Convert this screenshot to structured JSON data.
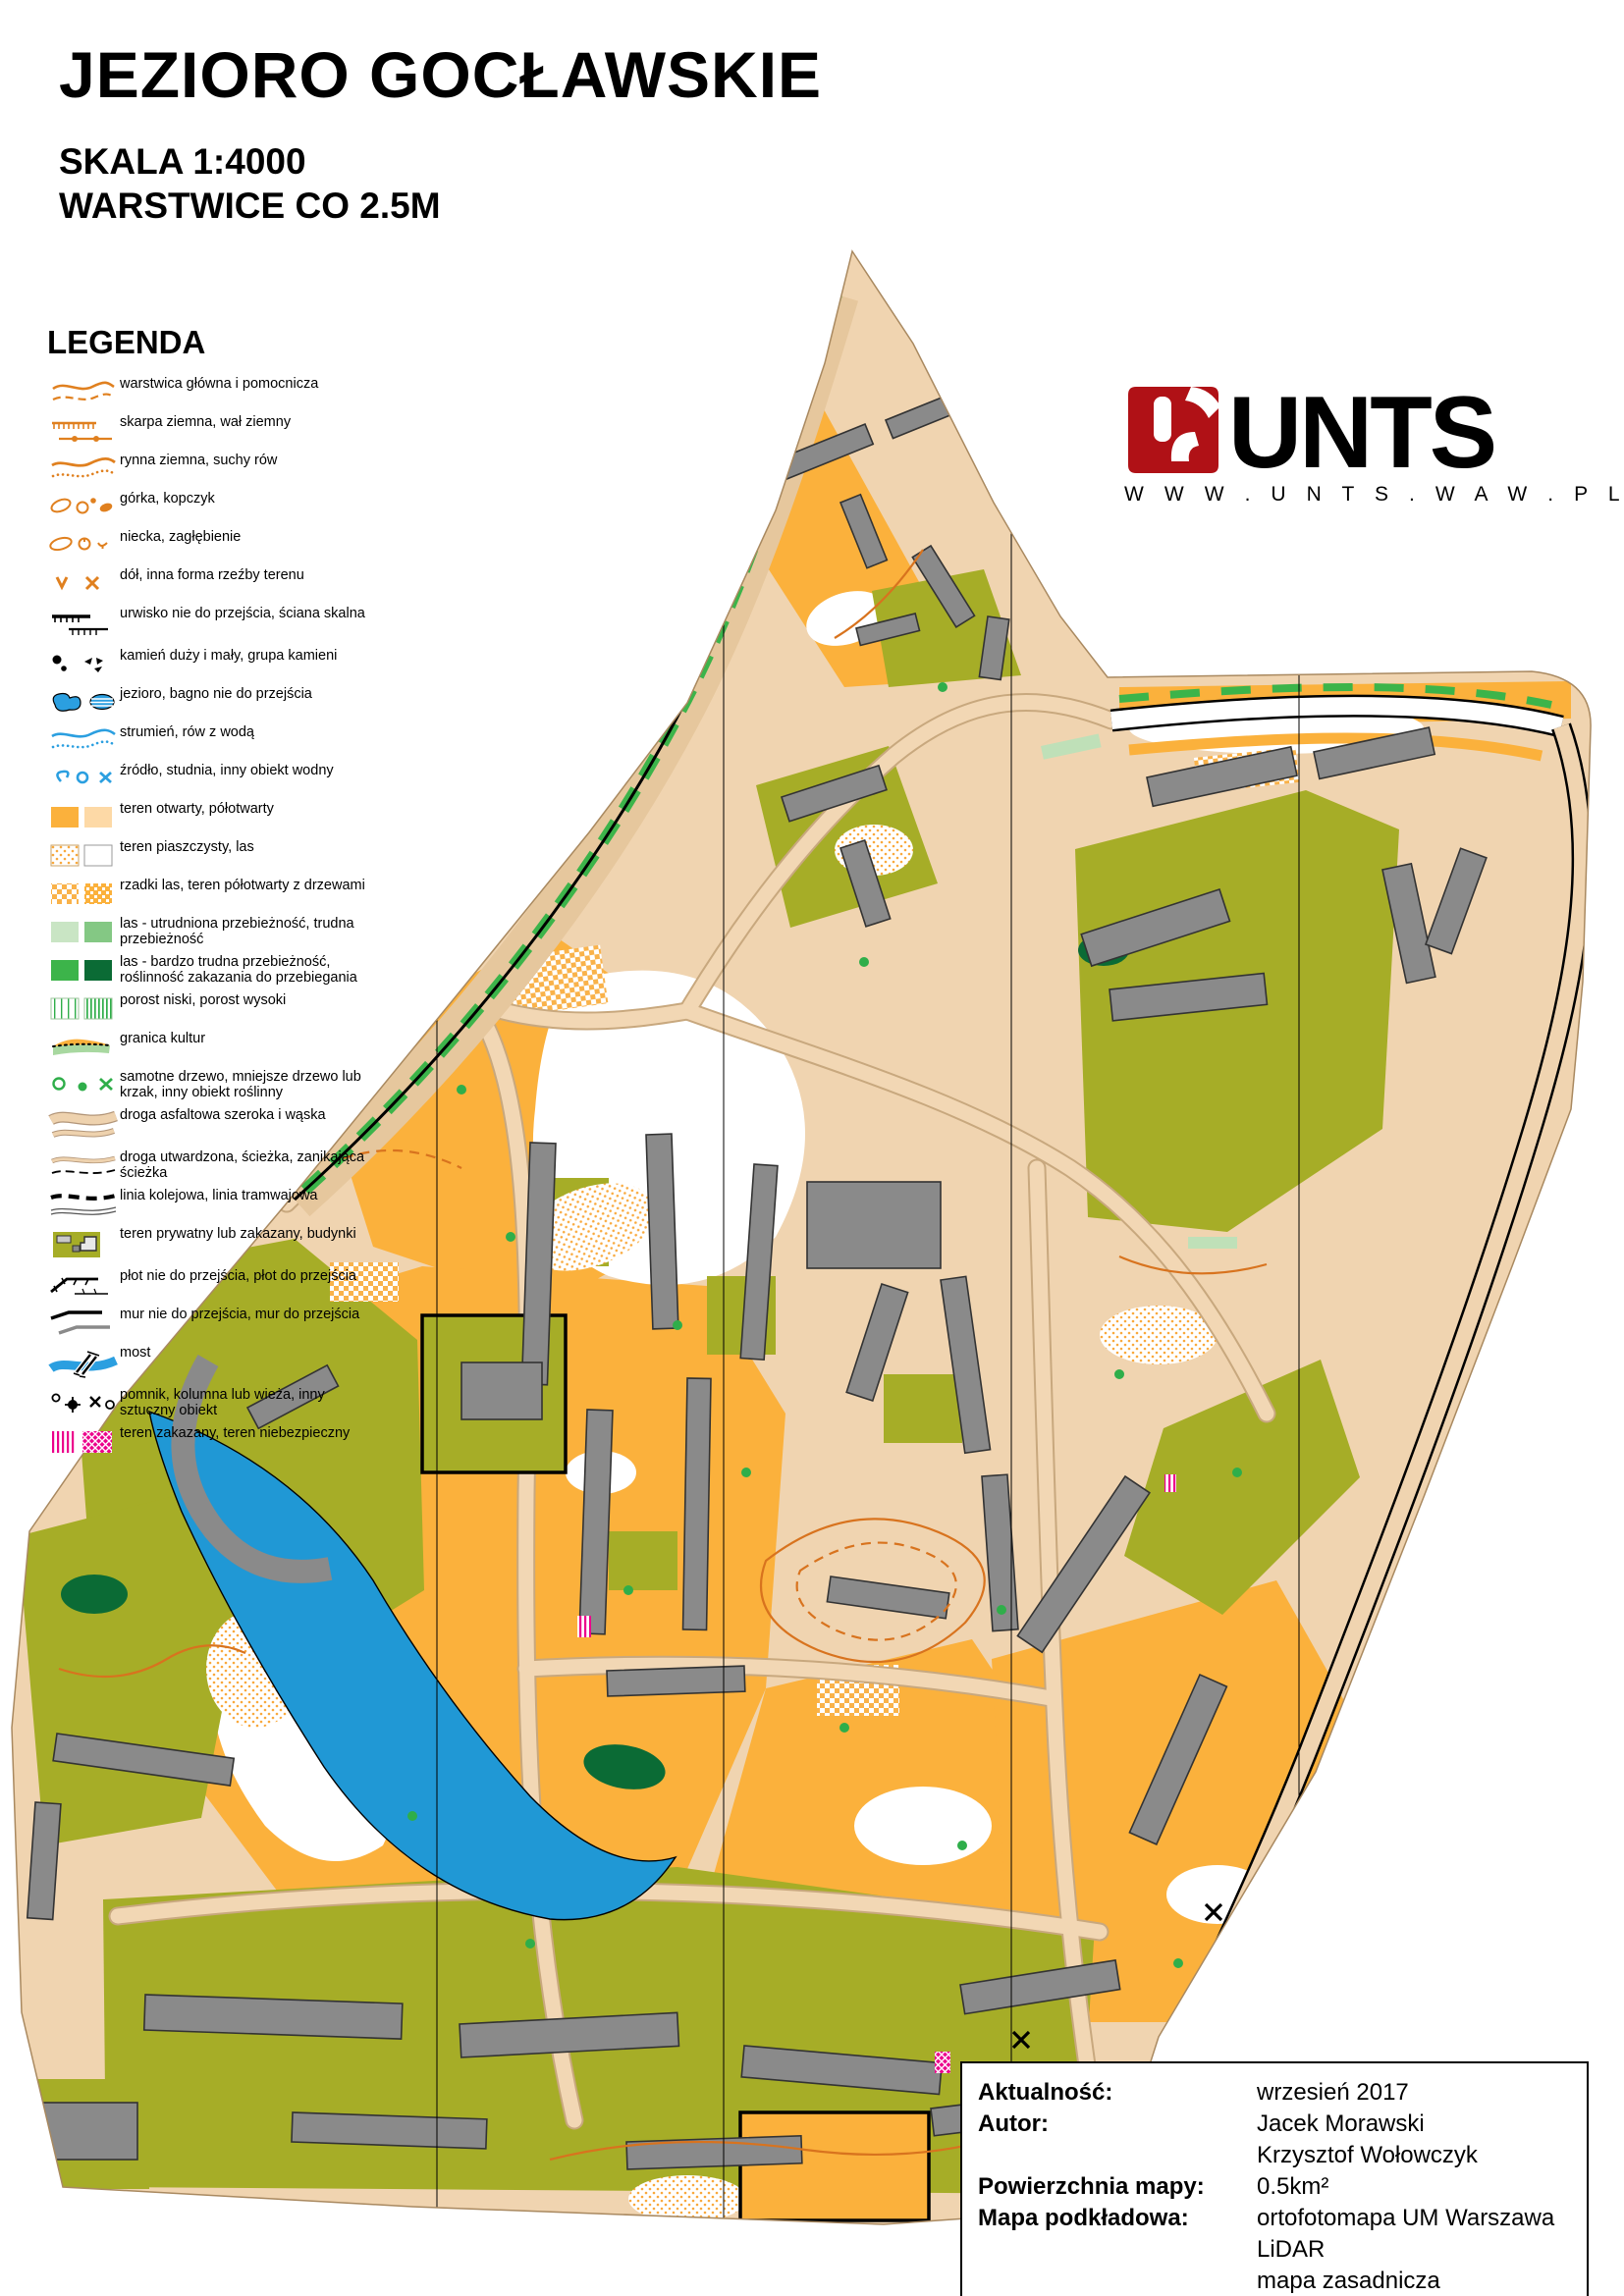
{
  "header": {
    "title": "JEZIORO GOCŁAWSKIE",
    "scale_line": "SKALA 1:4000",
    "contour_line": "WARSTWICE CO 2.5M"
  },
  "legend": {
    "heading": "LEGENDA",
    "items": [
      {
        "icon": "contour-main-helper-icon",
        "label": "warstwica główna i pomocnicza"
      },
      {
        "icon": "earth-slope-bank-icon",
        "label": "skarpa ziemna, wał ziemny"
      },
      {
        "icon": "earth-gully-dry-ditch-icon",
        "label": "rynna ziemna, suchy rów"
      },
      {
        "icon": "knoll-mound-icon",
        "label": "górka, kopczyk"
      },
      {
        "icon": "depression-hollow-icon",
        "label": "niecka, zagłębienie"
      },
      {
        "icon": "pit-landform-icon",
        "label": "dół, inna forma rzeźby terenu"
      },
      {
        "icon": "impassable-cliff-rockface-icon",
        "label": "urwisko nie do przejścia, ściana skalna"
      },
      {
        "icon": "boulder-stone-group-icon",
        "label": "kamień duży i mały, grupa kamieni"
      },
      {
        "icon": "lake-impassable-marsh-icon",
        "label": "jezioro, bagno nie do przejścia"
      },
      {
        "icon": "stream-water-ditch-icon",
        "label": "strumień, rów z wodą"
      },
      {
        "icon": "spring-well-water-object-icon",
        "label": "źródło, studnia, inny obiekt wodny"
      },
      {
        "icon": "open-semiopen-terrain-icon",
        "label": "teren otwarty, półotwarty"
      },
      {
        "icon": "sandy-terrain-forest-icon",
        "label": "teren piaszczysty, las"
      },
      {
        "icon": "sparse-forest-scattered-trees-icon",
        "label": "rzadki las, teren półotwarty z drzewami"
      },
      {
        "icon": "forest-slow-difficult-icon",
        "label": "las - utrudniona przebieżność, trudna przebieżność"
      },
      {
        "icon": "forest-very-difficult-forbidden-icon",
        "label": "las - bardzo trudna przebieżność, roślinność zakazania do przebiegania"
      },
      {
        "icon": "undergrowth-low-high-icon",
        "label": "porost niski, porost wysoki"
      },
      {
        "icon": "cultivation-boundary-icon",
        "label": "granica kultur"
      },
      {
        "icon": "lone-tree-bush-vegetation-icon",
        "label": "samotne drzewo, mniejsze drzewo lub krzak, inny obiekt roślinny"
      },
      {
        "icon": "paved-road-wide-narrow-icon",
        "label": "droga asfaltowa szeroka i wąska"
      },
      {
        "icon": "track-path-fading-path-icon",
        "label": "droga utwardzona, ścieżka, zanikająca ścieżka"
      },
      {
        "icon": "railway-tramway-icon",
        "label": "linia kolejowa, linia tramwajowa"
      },
      {
        "icon": "private-forbidden-area-buildings-icon",
        "label": "teren prywatny lub zakazany, budynki"
      },
      {
        "icon": "fence-impassable-passable-icon",
        "label": "płot nie do przejścia, płot do przejścia"
      },
      {
        "icon": "wall-impassable-passable-icon",
        "label": "mur nie do przejścia, mur do przejścia"
      },
      {
        "icon": "bridge-icon",
        "label": "most"
      },
      {
        "icon": "monument-column-tower-icon",
        "label": "pomnik, kolumna lub wieża, inny sztuczny obiekt"
      },
      {
        "icon": "forbidden-dangerous-area-icon",
        "label": "teren zakazany, teren niebezpieczny"
      }
    ]
  },
  "logo": {
    "name": "UNTS",
    "website": "W W W . U N T S . W A W . P L",
    "mark": "un-monogram-icon",
    "brand_red": "#b01116"
  },
  "credits": {
    "rows": [
      {
        "label": "Aktualność:",
        "values": [
          "wrzesień 2017"
        ]
      },
      {
        "label": "Autor:",
        "values": [
          "Jacek Morawski",
          "Krzysztof Wołowczyk"
        ]
      },
      {
        "label": "Powierzchnia mapy:",
        "values": [
          "0.5km²"
        ]
      },
      {
        "label": "Mapa podkładowa:",
        "values": [
          "ortofotomapa UM Warszawa",
          "LiDAR",
          "mapa zasadnicza"
        ]
      }
    ]
  },
  "map": {
    "colors": {
      "open_orange": "#fbb13c",
      "paved_beige": "#f0d4b0",
      "forbidden_olive": "#a6ad27",
      "building_gray": "#8a8a8a",
      "water_blue": "#2098d5",
      "forest_green": "#3cb44a",
      "dark_green": "#0b6b35",
      "contour_orange": "#d8731e",
      "danger_magenta": "#ec008c"
    }
  }
}
